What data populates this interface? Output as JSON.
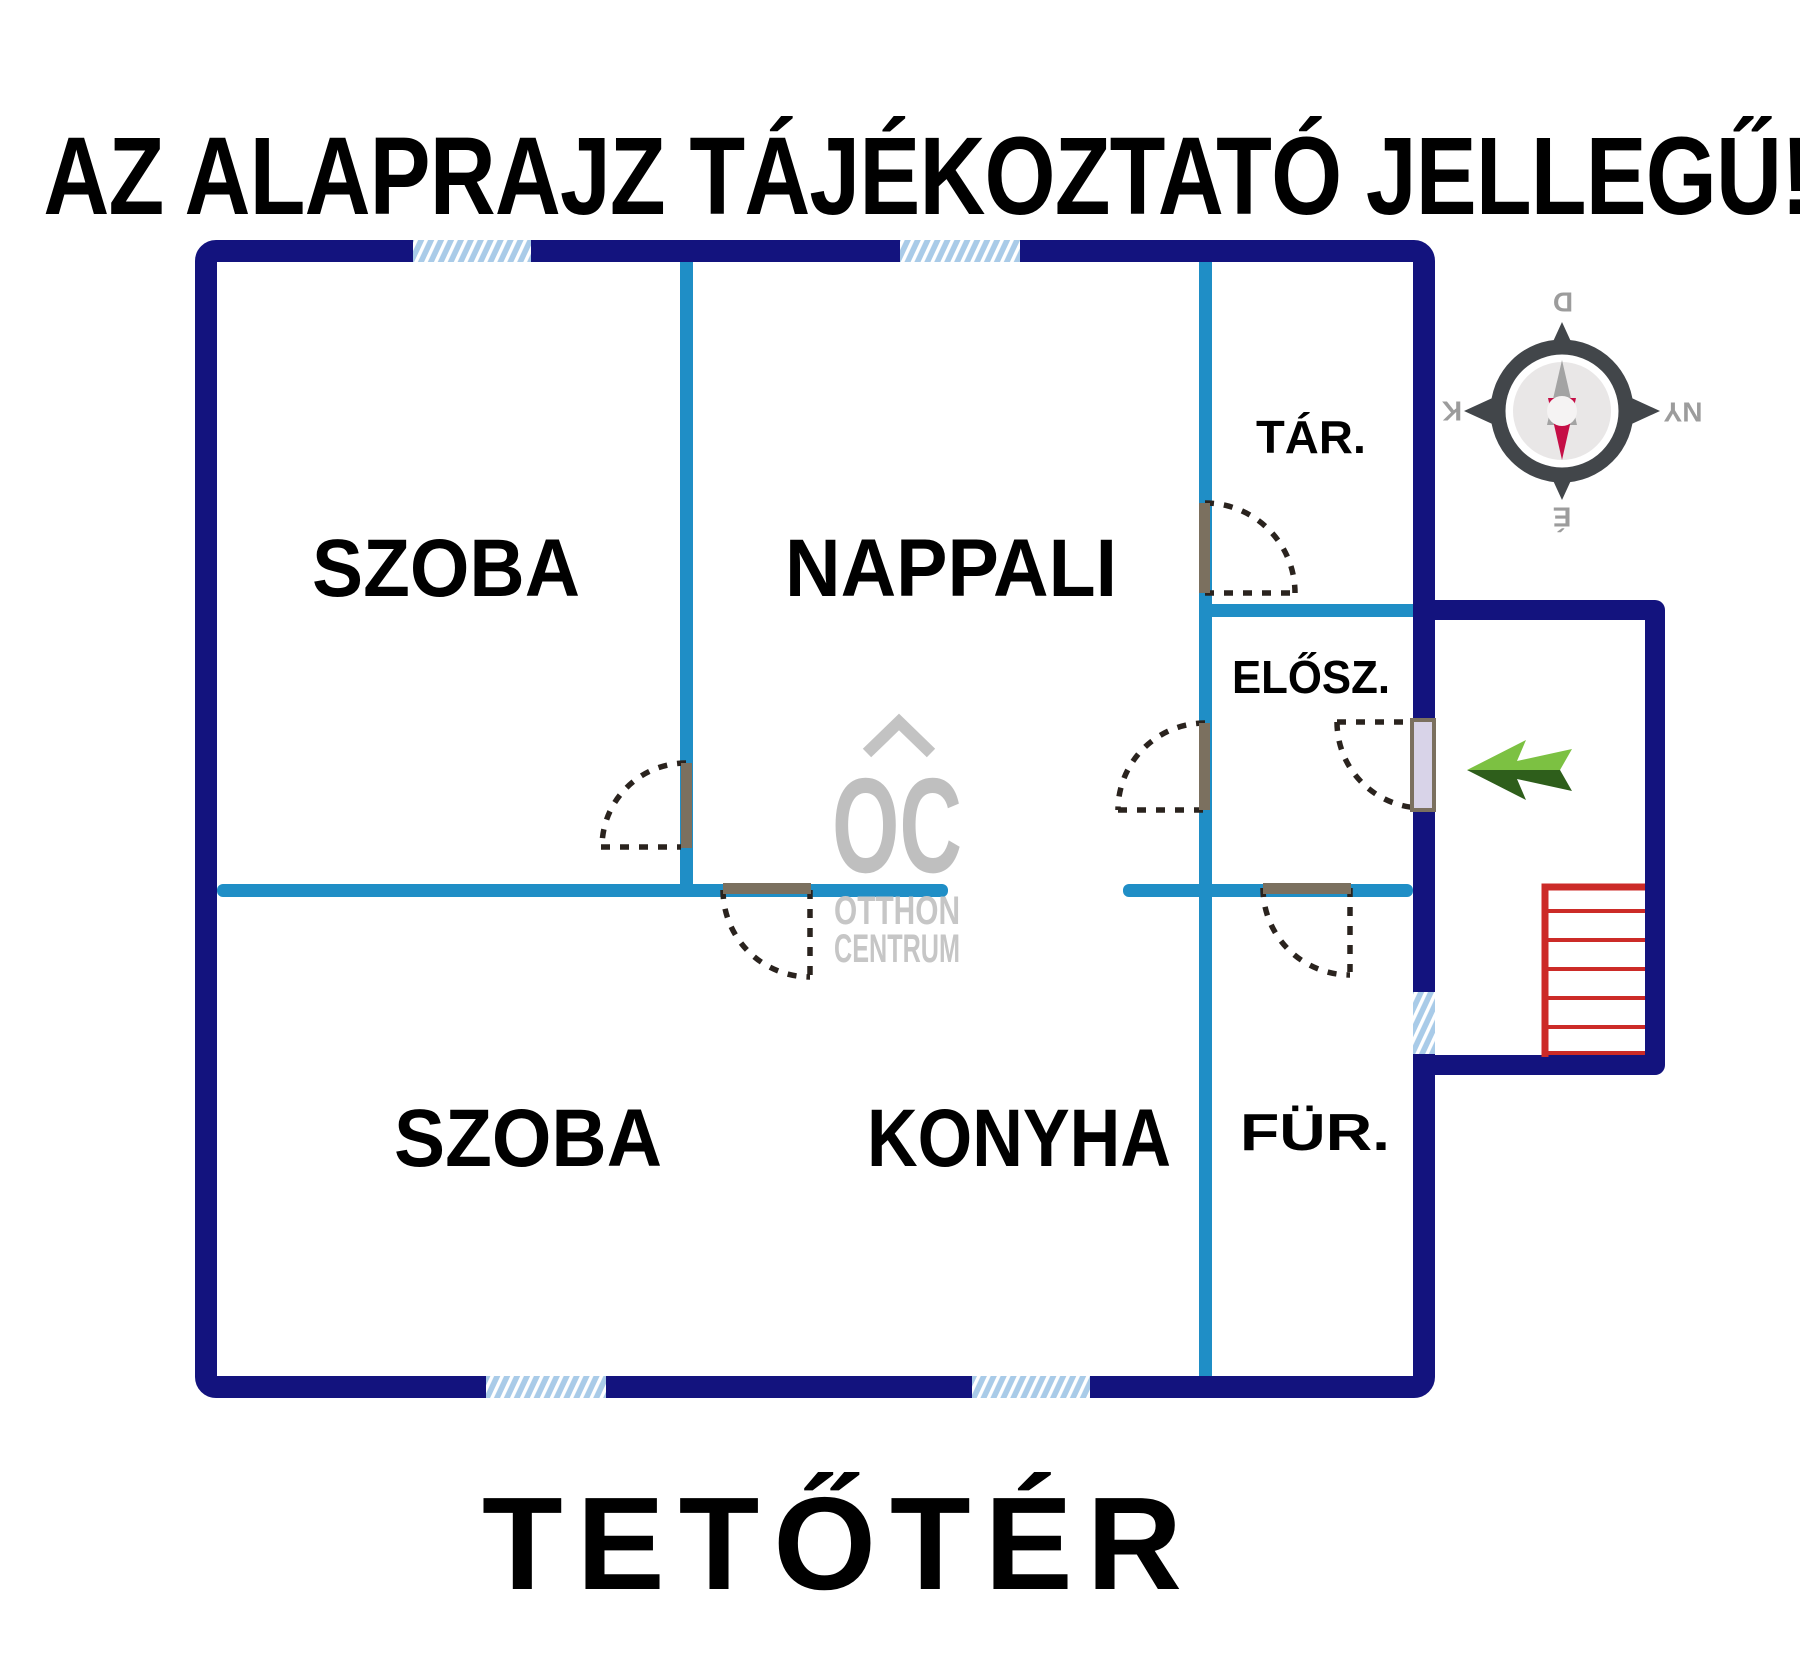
{
  "title": "AZ ALAPRAJZ TÁJÉKOZTATÓ JELLEGŰ!",
  "floor_label": "TETŐTÉR",
  "rooms": {
    "szoba_top": "SZOBA",
    "nappali": "NAPPALI",
    "tar": "TÁR.",
    "elosz": "ELŐSZ.",
    "szoba_bottom": "SZOBA",
    "konyha": "KONYHA",
    "fur": "FÜR."
  },
  "compass": {
    "top": "D",
    "left": "K",
    "right": "NY",
    "bottom": "É"
  },
  "watermark": {
    "monogram": "OC",
    "line1": "OTTHON",
    "line2": "CENTRUM"
  },
  "colors": {
    "wall_outer": "#13137E",
    "wall_inner": "#1F8EC6",
    "window_fill": "#A9CBE8",
    "door_leaf": "#7B705F",
    "entrance_leaf": "#D8D3E8",
    "stairs": "#CC2B28",
    "arrow_light": "#7CC142",
    "arrow_dark": "#2E5E1B",
    "compass_body": "#42464A",
    "compass_text": "#9C9C9C",
    "needle_north": "#A3A3A3",
    "needle_south": "#C50E46",
    "watermark_gray": "#C0C0C0"
  }
}
